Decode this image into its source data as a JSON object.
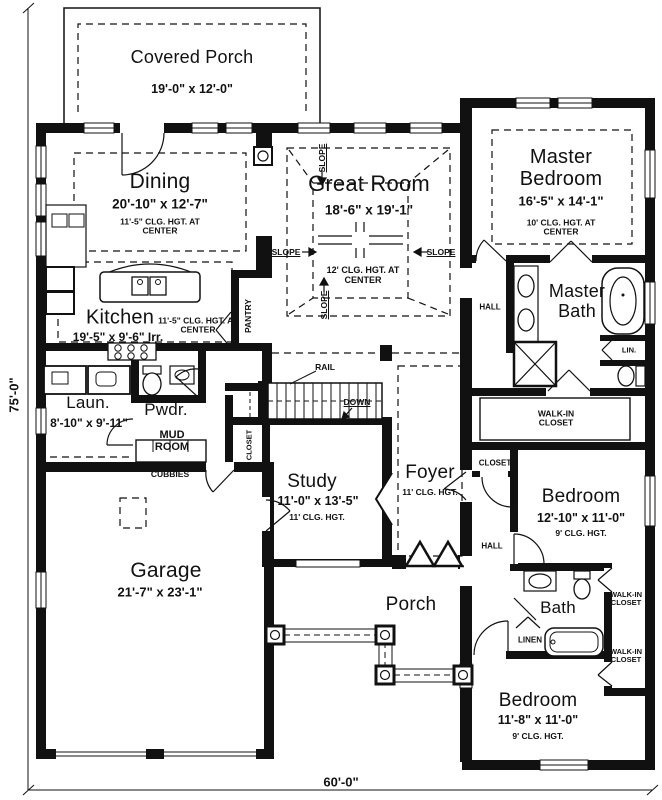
{
  "plan_dimensions": {
    "overall_depth": "75'-0\"",
    "overall_width": "60'-0\""
  },
  "rooms": {
    "covered_porch": {
      "name": "Covered Porch",
      "dims": "19'-0\" x 12'-0\""
    },
    "dining": {
      "name": "Dining",
      "dims": "20'-10\" x 12'-7\"",
      "note": "11'-5\" CLG. HGT. AT CENTER"
    },
    "great_room": {
      "name": "Great Room",
      "dims": "18'-6\" x 19'-1\"",
      "note": "12' CLG. HGT. AT CENTER"
    },
    "master_bedroom": {
      "name": "Master Bedroom",
      "dims": "16'-5\" x 14'-1\"",
      "note": "10' CLG. HGT. AT CENTER"
    },
    "kitchen": {
      "name": "Kitchen",
      "dims": "19'-5\" x 9'-6\" Irr.",
      "note": "11'-5\" CLG. HGT. AT CENTER"
    },
    "laundry": {
      "name": "Laun.",
      "dims": "8'-10\" x 9'-11\""
    },
    "powder": {
      "name": "Pwdr."
    },
    "mud_room": {
      "name": "MUD ROOM"
    },
    "study": {
      "name": "Study",
      "dims": "11'-0\" x 13'-5\"",
      "note": "11' CLG. HGT."
    },
    "foyer": {
      "name": "Foyer",
      "note": "11' CLG. HGT."
    },
    "garage": {
      "name": "Garage",
      "dims": "21'-7\" x 23'-1\""
    },
    "porch": {
      "name": "Porch"
    },
    "master_bath": {
      "name": "Master Bath"
    },
    "bedroom2": {
      "name": "Bedroom",
      "dims": "12'-10\" x 11'-0\"",
      "note": "9' CLG. HGT."
    },
    "bath2": {
      "name": "Bath"
    },
    "bedroom3": {
      "name": "Bedroom",
      "dims": "11'-8\" x 11'-0\"",
      "note": "9' CLG. HGT."
    }
  },
  "labels": {
    "pantry": "PANTRY",
    "rail": "RAIL",
    "down": "DOWN",
    "closet": "CLOSET",
    "hall": "HALL",
    "cubbies": "CUBBIES",
    "lin": "LIN.",
    "linen": "LINEN",
    "walk_in_closet": "WALK-IN CLOSET",
    "slope": "SLOPE"
  }
}
